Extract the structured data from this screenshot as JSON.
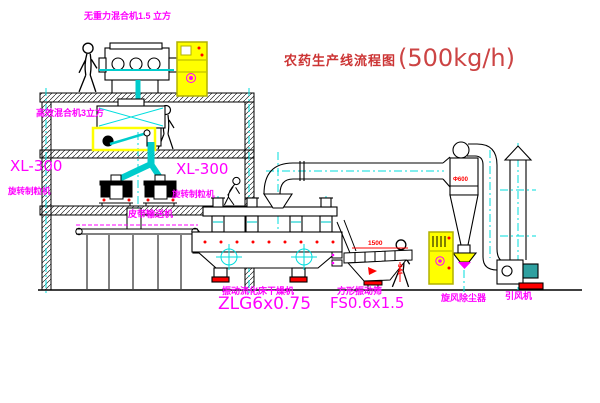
{
  "title": {
    "text": "农药生产线流程图",
    "capacity": "(500kg/h)"
  },
  "labels": {
    "top_mixer": "无重力混合机1.5 立方",
    "floor2_mixer": "高效混合机3立方",
    "granulator_left_model": "XL-300",
    "granulator_left_name": "旋转制粒机",
    "granulator_right_model": "XL-300",
    "granulator_right_name": "旋转制粒机",
    "belt_conveyor": "皮带输送机",
    "dryer_name": "振动流化床干燥机",
    "dryer_model": "ZLG6x0.75",
    "screen_name": "方形振动筛",
    "screen_model": "FS0.6x1.5",
    "cyclone_name": "旋风除尘器",
    "fan_name": "引风机"
  },
  "dimensions": {
    "screen_length": "1500",
    "screen_height": "941",
    "cyclone_diameter": "Φ600"
  },
  "colors": {
    "line": "#000000",
    "centerline": "#00dddd",
    "material_flow": "#00cccc",
    "label": "#ff00ff",
    "title": "#cc3434",
    "dimension": "#ff0000",
    "cabinet": "#ffff00",
    "base_pad": "#ff0000"
  }
}
